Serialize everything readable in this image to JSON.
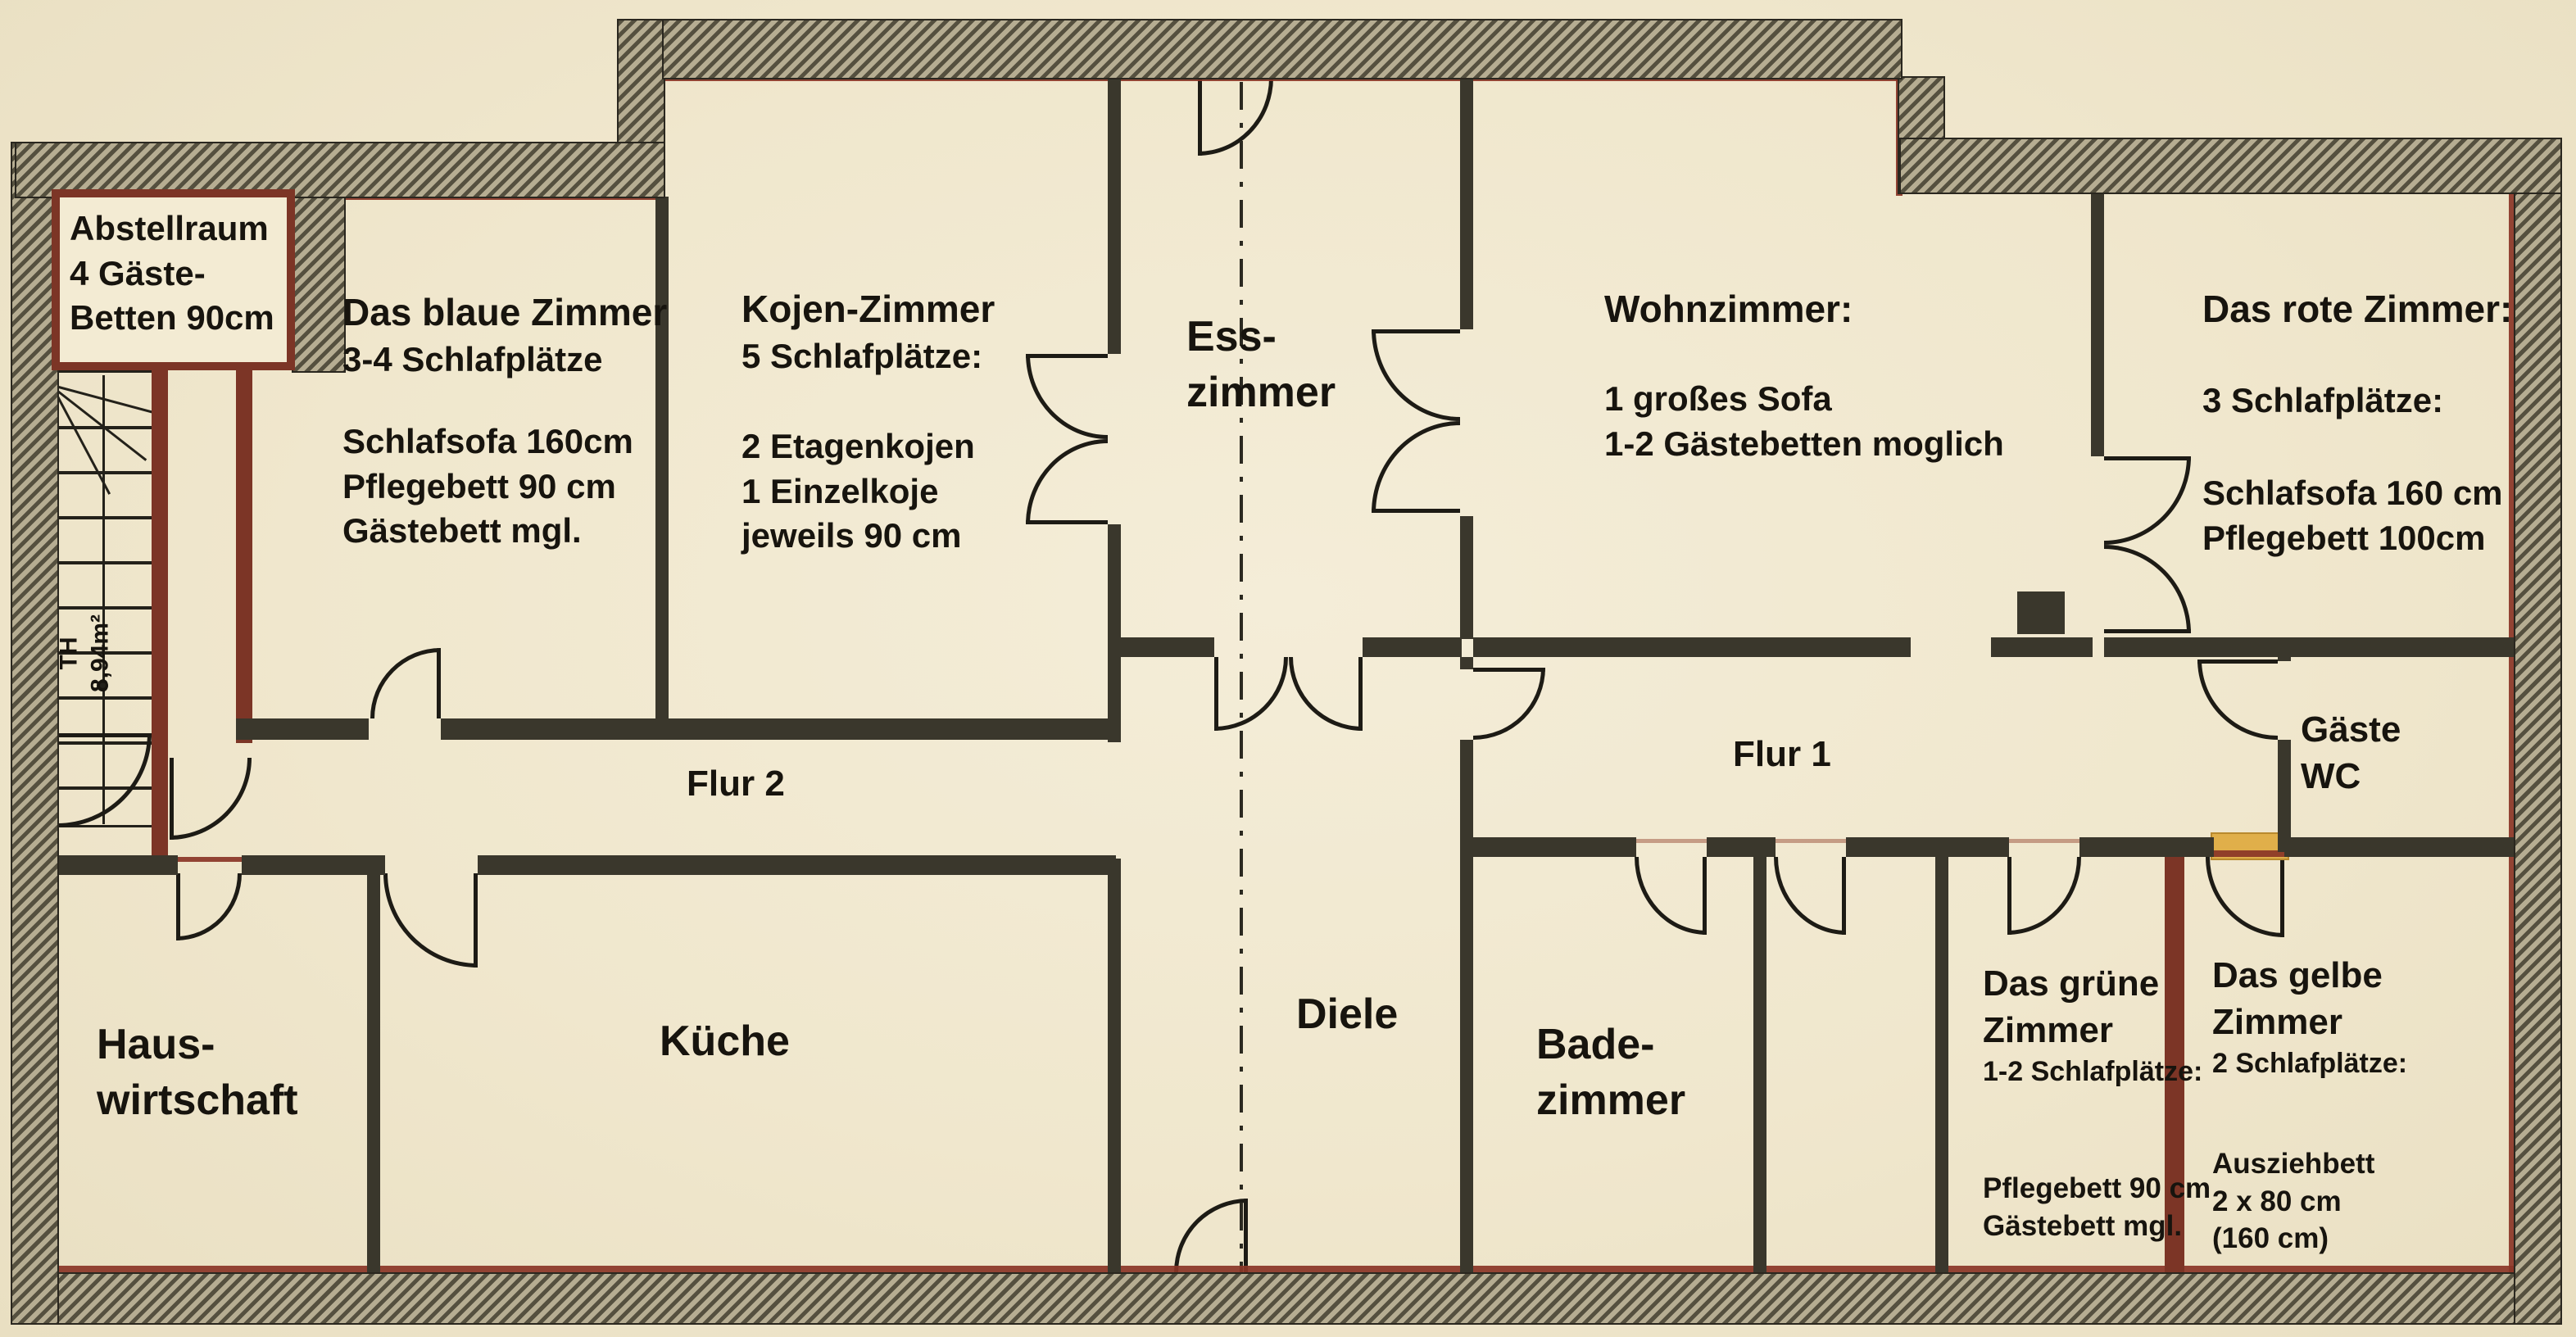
{
  "rooms": {
    "abstellraum": {
      "title": "Abstellraum",
      "line1": "4 Gäste-",
      "line2": "Betten 90cm"
    },
    "blaues_zimmer": {
      "title": "Das blaue Zimmer",
      "subtitle": "3-4 Schlafplätze",
      "details": [
        "Schlafsofa 160cm",
        "Pflegebett 90 cm",
        "Gästebett mgl."
      ]
    },
    "kojen_zimmer": {
      "title": "Kojen-Zimmer",
      "subtitle": "5 Schlafplätze:",
      "details": [
        "2 Etagenkojen",
        "1 Einzelkoje",
        "jeweils 90 cm"
      ]
    },
    "esszimmer": {
      "title_line1": "Ess-",
      "title_line2": "zimmer"
    },
    "wohnzimmer": {
      "title": "Wohnzimmer:",
      "details": [
        "1 großes Sofa",
        "1-2 Gästebetten moglich"
      ]
    },
    "rotes_zimmer": {
      "title": "Das rote Zimmer:",
      "subtitle": "3 Schlafplätze:",
      "details": [
        "Schlafsofa 160 cm",
        "Pflegebett 100cm"
      ]
    },
    "flur2": {
      "title": "Flur 2"
    },
    "flur1": {
      "title": "Flur 1"
    },
    "gaeste_wc": {
      "title_line1": "Gäste",
      "title_line2": "WC"
    },
    "hauswirtschaft": {
      "title_line1": "Haus-",
      "title_line2": "wirtschaft"
    },
    "kueche": {
      "title": "Küche"
    },
    "diele": {
      "title": "Diele"
    },
    "badezimmer": {
      "title_line1": "Bade-",
      "title_line2": "zimmer"
    },
    "gruenes_zimmer": {
      "title_line1": "Das grüne",
      "title_line2": "Zimmer",
      "subtitle": "1-2 Schlafplätze:",
      "details": [
        "Pflegebett 90 cm",
        "Gästebett mgl."
      ]
    },
    "gelbes_zimmer": {
      "title_line1": "Das gelbe",
      "title_line2": "Zimmer",
      "subtitle": "2 Schlafplätze:",
      "details": [
        "Ausziehbett",
        "2 x 80 cm",
        "(160 cm)"
      ]
    },
    "treppenhaus": {
      "label": "TH",
      "area": "8,94m²"
    }
  },
  "colors": {
    "boundary_red": "#8a3526",
    "wall_red": "#7c3526",
    "highlight_yellow": "#e0af4a",
    "wall_dark": "#3a372c",
    "paper": "#f2ead2"
  }
}
